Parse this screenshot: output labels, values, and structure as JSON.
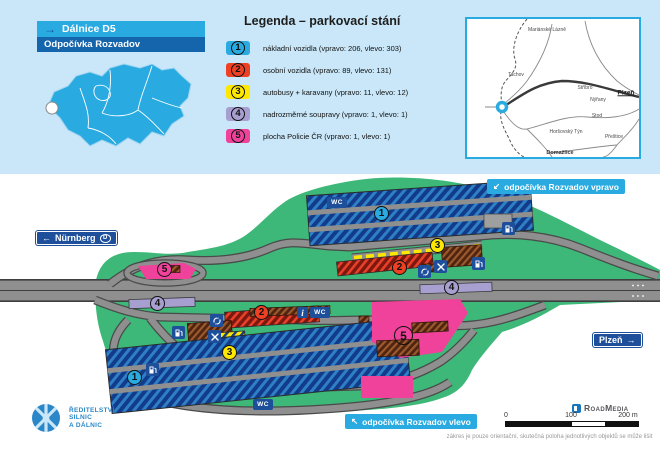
{
  "header": {
    "arrow": "→",
    "road": "Dálnice D5",
    "site": "Odpočívka Rozvadov"
  },
  "legend": {
    "title": "Legenda – parkovací stání",
    "items": [
      {
        "number": "1",
        "color": "#29abe2",
        "label": "nákladní vozidla (vpravo: 206, vlevo: 303)"
      },
      {
        "number": "2",
        "color": "#ee4023",
        "label": "osobní vozidla (vpravo: 89, vlevo: 131)"
      },
      {
        "number": "3",
        "color": "#ffe800",
        "label": "autobusy + karavany (vpravo: 11, vlevo: 12)"
      },
      {
        "number": "4",
        "color": "#a79fcf",
        "label": "nadrozměrné soupravy (vpravo: 1, vlevo: 1)"
      },
      {
        "number": "5",
        "color": "#f0419b",
        "label": "plocha Policie ČR (vpravo: 1, vlevo: 1)"
      }
    ]
  },
  "region_map": {
    "towns": [
      "Mariánské Lázně",
      "Tachov",
      "Stříbro",
      "Nýřany",
      "Plzeň",
      "Stod",
      "Horšovský Týn",
      "Přeštice",
      "Domažlice"
    ]
  },
  "signs": {
    "nurnberg": {
      "arrow": "←",
      "label": "Nürnberg",
      "badge": "D"
    },
    "plzen": {
      "label": "Plzeň",
      "arrow": "→"
    },
    "vpravo": {
      "arrow": "↙",
      "label": "odpočívka Rozvadov vpravo"
    },
    "vlevo": {
      "arrow": "↖",
      "label": "odpočívka Rozvadov vlevo"
    }
  },
  "map": {
    "wc_label": "WC",
    "info_label": "i"
  },
  "icons": {
    "fuel": "fuel-pump",
    "restaurant": "fork-and-knife",
    "turnaround": "circular-arrows",
    "info": "letter-i",
    "wc": "WC-letters",
    "cz_marker": "white-dot",
    "region_marker": "blue-ring"
  },
  "colors": {
    "accent_cyan": "#29abe2",
    "navy": "#1d4f9b",
    "green": "#3db878",
    "road_gray": "#8f8f8f",
    "truck_parking": "#123c8a",
    "car_parking": "#ee4023",
    "bus_parking": "#ffe800",
    "oversize_parking": "#a79fcf",
    "police_area": "#f0419b"
  },
  "footer": {
    "agency": [
      "ŘEDITELSTVÍ",
      "SILNIC",
      "A DÁLNIC"
    ],
    "brand": "RoadMedia",
    "scale": [
      "0",
      "100",
      "200 m"
    ],
    "disclaimer": "zákres je pouze orientační, skutečná poloha jednotlivých objektů se může lišit"
  }
}
